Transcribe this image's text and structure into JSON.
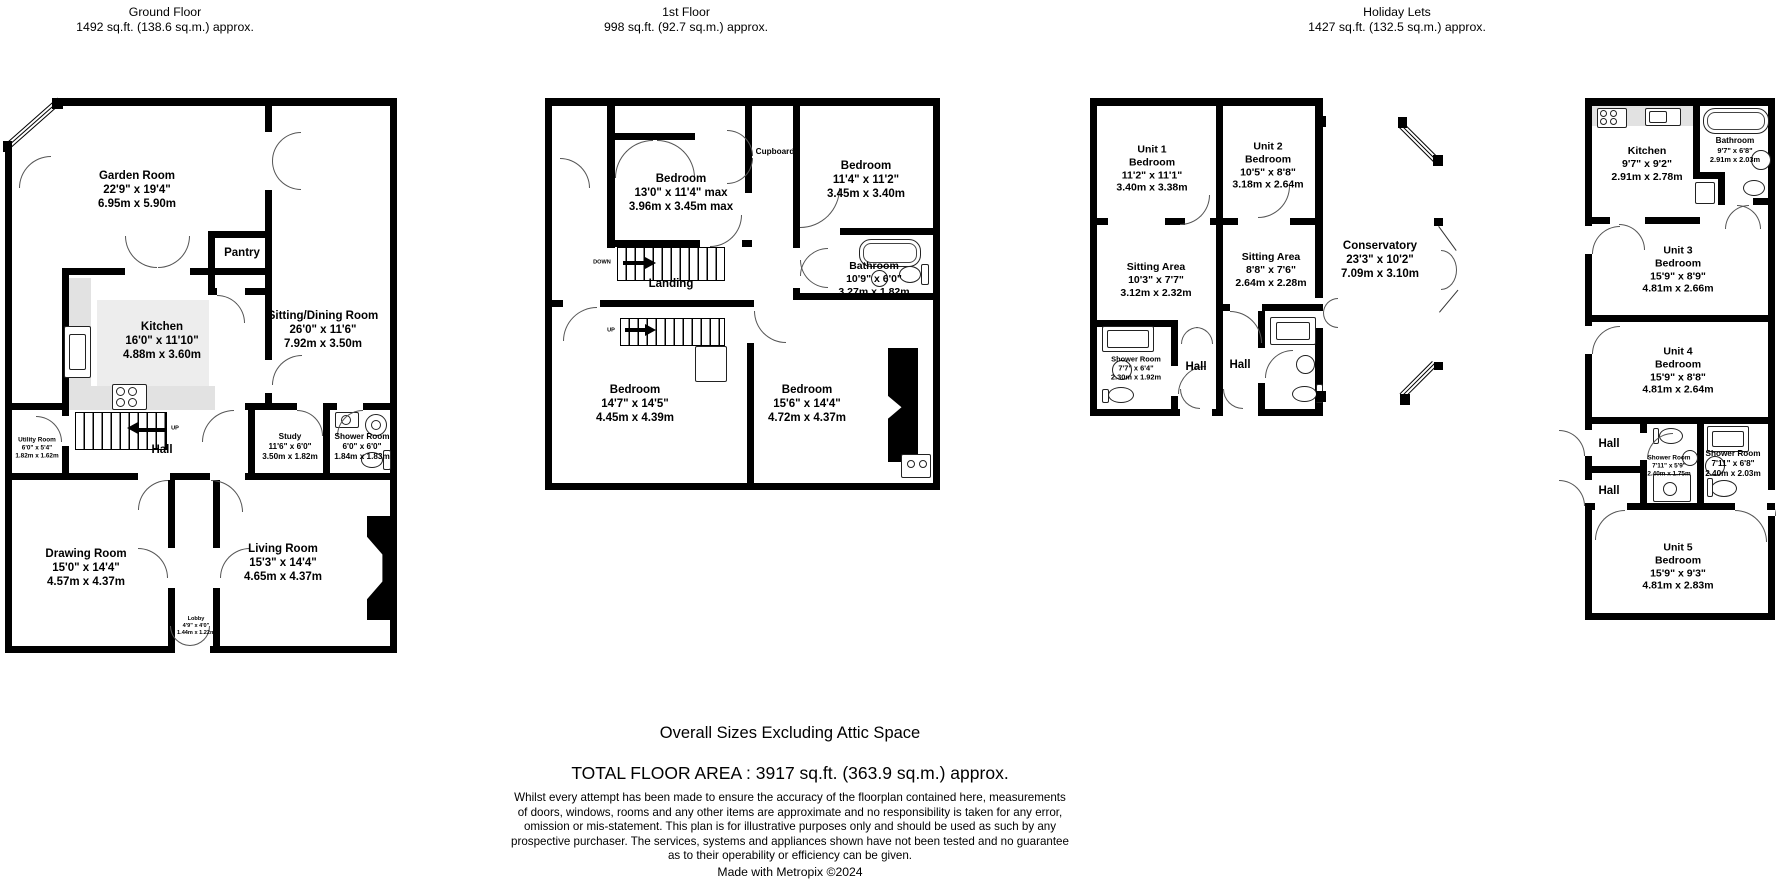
{
  "ground": {
    "title": "Ground Floor",
    "subtitle": "1492 sq.ft. (138.6 sq.m.) approx.",
    "stairs_up": "UP",
    "rooms": {
      "garden": {
        "name": "Garden Room",
        "imperial": "22'9\" x 19'4\"",
        "metric": "6.95m x 5.90m"
      },
      "pantry": {
        "name": "Pantry"
      },
      "sitting_dining": {
        "name": "Sitting/Dining Room",
        "imperial": "26'0\" x 11'6\"",
        "metric": "7.92m x 3.50m"
      },
      "kitchen": {
        "name": "Kitchen",
        "imperial": "16'0\" x 11'10\"",
        "metric": "4.88m x 3.60m"
      },
      "utility": {
        "name": "Utility Room",
        "imperial": "6'0\" x 5'4\"",
        "metric": "1.82m x 1.62m"
      },
      "hall": {
        "name": "Hall"
      },
      "study": {
        "name": "Study",
        "imperial": "11'6\" x 6'0\"",
        "metric": "3.50m x 1.82m"
      },
      "shower": {
        "name": "Shower Room",
        "imperial": "6'0\" x 6'0\"",
        "metric": "1.84m x 1.83m"
      },
      "drawing": {
        "name": "Drawing Room",
        "imperial": "15'0\" x 14'4\"",
        "metric": "4.57m x 4.37m"
      },
      "lobby": {
        "name": "Lobby",
        "imperial": "4'9\" x 4'0\"",
        "metric": "1.44m x 1.22m"
      },
      "living": {
        "name": "Living Room",
        "imperial": "15'3\" x 14'4\"",
        "metric": "4.65m x 4.37m"
      }
    }
  },
  "first": {
    "title": "1st Floor",
    "subtitle": "998 sq.ft. (92.7 sq.m.) approx.",
    "stairs_down": "DOWN",
    "stairs_up": "UP",
    "rooms": {
      "bed1": {
        "name": "Bedroom",
        "imperial": "13'0\" x 11'4\" max",
        "metric": "3.96m x 3.45m max"
      },
      "cupboard": {
        "name": "Cupboard"
      },
      "bed2": {
        "name": "Bedroom",
        "imperial": "11'4\" x 11'2\"",
        "metric": "3.45m x 3.40m"
      },
      "landing": {
        "name": "Landing"
      },
      "bathroom": {
        "name": "Bathroom",
        "imperial": "10'9\" x 6'0\"",
        "metric": "3.27m x 1.82m"
      },
      "bed3": {
        "name": "Bedroom",
        "imperial": "14'7\" x 14'5\"",
        "metric": "4.45m x 4.39m"
      },
      "bed4": {
        "name": "Bedroom",
        "imperial": "15'6\" x 14'4\"",
        "metric": "4.72m x 4.37m"
      }
    }
  },
  "holiday": {
    "title": "Holiday Lets",
    "subtitle": "1427 sq.ft. (132.5 sq.m.) approx.",
    "rooms": {
      "unit1_bed": {
        "unit": "Unit 1",
        "name": "Bedroom",
        "imperial": "11'2\" x 11'1\"",
        "metric": "3.40m x 3.38m"
      },
      "unit2_bed": {
        "unit": "Unit 2",
        "name": "Bedroom",
        "imperial": "10'5\" x 8'8\"",
        "metric": "3.18m x 2.64m"
      },
      "sitting1": {
        "name": "Sitting Area",
        "imperial": "10'3\" x 7'7\"",
        "metric": "3.12m x 2.32m"
      },
      "sitting2": {
        "name": "Sitting Area",
        "imperial": "8'8\" x 7'6\"",
        "metric": "2.64m x 2.28m"
      },
      "conservatory": {
        "name": "Conservatory",
        "imperial": "23'3\" x 10'2\"",
        "metric": "7.09m x 3.10m"
      },
      "shower1": {
        "name": "Shower Room",
        "imperial": "7'7\" x 6'4\"",
        "metric": "2.30m x 1.92m"
      },
      "hall1": {
        "name": "Hall"
      },
      "hall2": {
        "name": "Hall"
      },
      "kitchen": {
        "name": "Kitchen",
        "imperial": "9'7\" x 9'2\"",
        "metric": "2.91m x 2.78m"
      },
      "bathroom": {
        "name": "Bathroom",
        "imperial": "9'7\" x 6'8\"",
        "metric": "2.91m x 2.03m"
      },
      "unit3_bed": {
        "unit": "Unit 3",
        "name": "Bedroom",
        "imperial": "15'9\" x 8'9\"",
        "metric": "4.81m x 2.66m"
      },
      "unit4_bed": {
        "unit": "Unit 4",
        "name": "Bedroom",
        "imperial": "15'9\" x 8'8\"",
        "metric": "4.81m x 2.64m"
      },
      "hall3": {
        "name": "Hall"
      },
      "hall4": {
        "name": "Hall"
      },
      "shower_a": {
        "name": "Shower Room",
        "imperial": "7'11\" x 5'9\"",
        "metric": "2.40m x 1.75m"
      },
      "shower_b": {
        "name": "Shower Room",
        "imperial": "7'11\" x 6'8\"",
        "metric": "2.40m x 2.03m"
      },
      "unit5_bed": {
        "unit": "Unit 5",
        "name": "Bedroom",
        "imperial": "15'9\" x 9'3\"",
        "metric": "4.81m x 2.83m"
      }
    }
  },
  "footer": {
    "sizes_note": "Overall Sizes Excluding Attic Space",
    "total": "TOTAL FLOOR AREA : 3917 sq.ft. (363.9 sq.m.) approx.",
    "disclaimer_lines": [
      "Whilst every attempt has been made to ensure the accuracy of the floorplan contained here, measurements",
      "of doors, windows, rooms and any other items are approximate and no responsibility is taken for any error,",
      "omission or mis-statement. This plan is for illustrative purposes only and should be used as such by any",
      "prospective purchaser. The services, systems and appliances shown have not been tested and no guarantee",
      "as to their operability or efficiency can be given."
    ],
    "credit": "Made with Metropix ©2024"
  }
}
